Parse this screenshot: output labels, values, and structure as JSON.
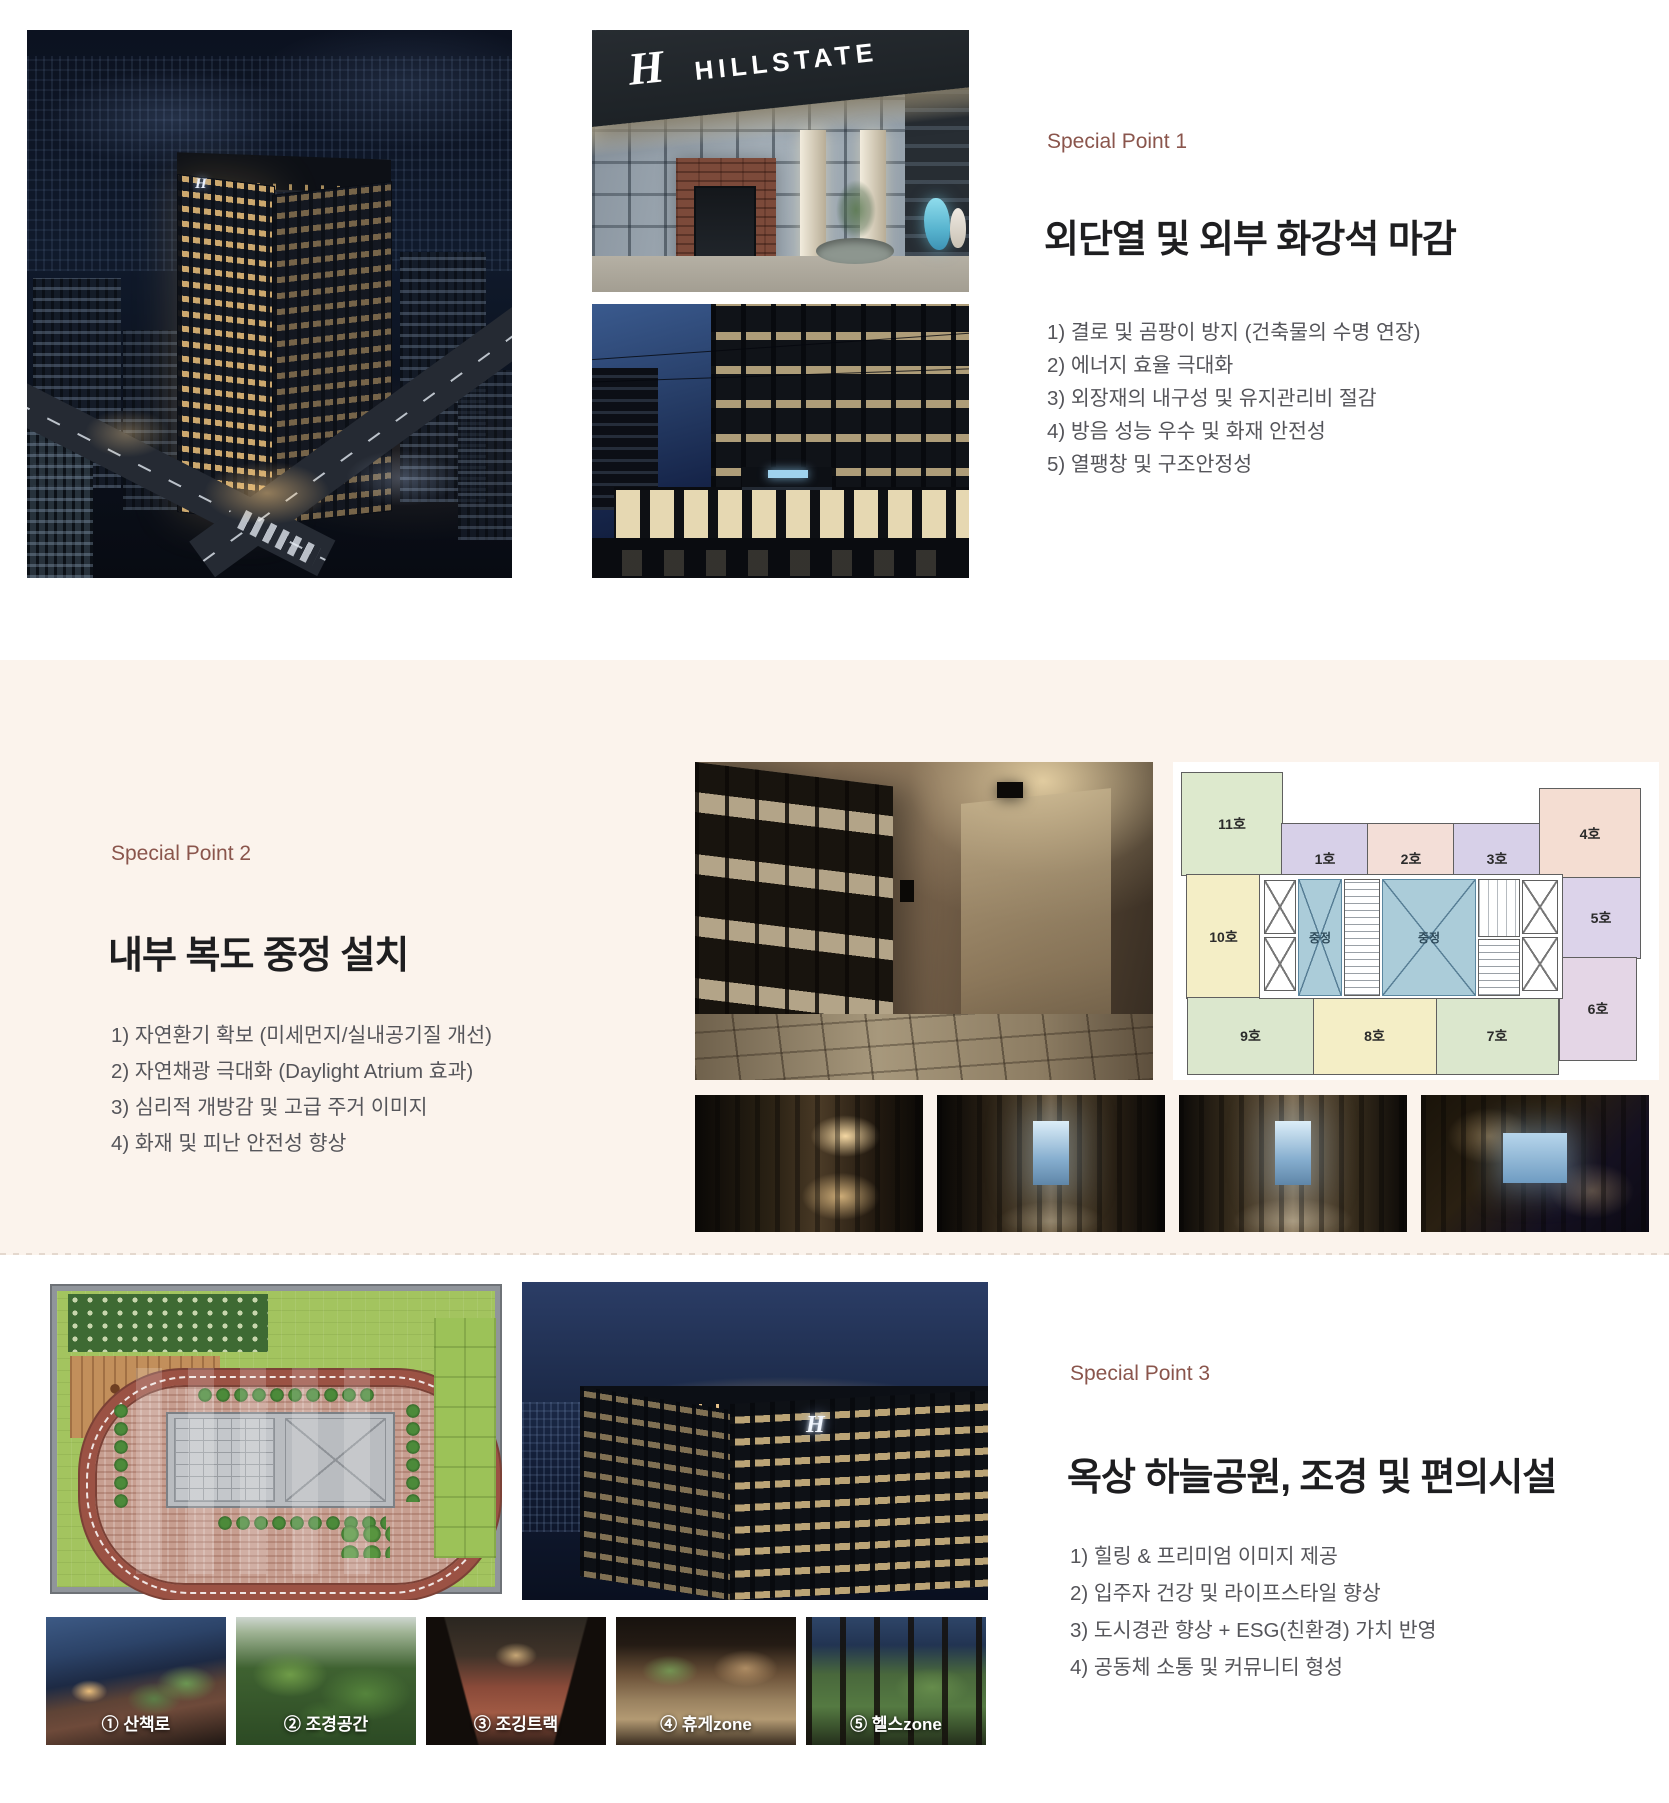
{
  "page": {
    "background": "#ffffff",
    "band_background": "#fbf3ec",
    "accent_color": "#8a554c"
  },
  "sign": {
    "monogram": "H",
    "name": "HILLSTATE"
  },
  "sections": [
    {
      "label": "Special Point 1",
      "heading": "외단열 및 외부 화강석 마감",
      "items": [
        "1) 결로 및 곰팡이 방지 (건축물의 수명 연장)",
        "2) 에너지 효율 극대화",
        "3) 외장재의 내구성 및 유지관리비 절감",
        "4) 방음 성능 우수 및 화재 안전성",
        "5) 열팽창 및 구조안정성"
      ]
    },
    {
      "label": "Special Point 2",
      "heading": "내부 복도 중정 설치",
      "items": [
        "1) 자연환기 확보 (미세먼지/실내공기질 개선)",
        "2) 자연채광 극대화 (Daylight Atrium 효과)",
        "3) 심리적 개방감 및 고급 주거 이미지",
        "4) 화재 및 피난 안전성 향상"
      ]
    },
    {
      "label": "Special Point 3",
      "heading": "옥상 하늘공원, 조경 및 편의시설",
      "items": [
        "1) 힐링 & 프리미엄 이미지 제공",
        "2) 입주자 건강 및 라이프스타일 향상",
        "3) 도시경관 향상 + ESG(친환경) 가치 반영",
        "4) 공동체 소통 및 커뮤니티 형성"
      ]
    }
  ],
  "floorplan": {
    "atrium_label": "중정",
    "atrium_color": "#abccd9",
    "units": [
      {
        "label": "11호",
        "color": "#dde9cd"
      },
      {
        "label": "10호",
        "color": "#f4eec6"
      },
      {
        "label": "1호",
        "color": "#d7d0e8"
      },
      {
        "label": "2호",
        "color": "#f3ded7"
      },
      {
        "label": "3호",
        "color": "#d7d0e8"
      },
      {
        "label": "4호",
        "color": "#f4ddd2"
      },
      {
        "label": "5호",
        "color": "#dcd3ea"
      },
      {
        "label": "6호",
        "color": "#e4d6e6"
      },
      {
        "label": "7호",
        "color": "#dbe7cd"
      },
      {
        "label": "8호",
        "color": "#f4eec6"
      },
      {
        "label": "9호",
        "color": "#dbe7cd"
      }
    ]
  },
  "rooftop_captions": [
    "① 산책로",
    "② 조경공간",
    "③ 조깅트랙",
    "④ 휴게zone",
    "⑤ 헬스zone"
  ]
}
